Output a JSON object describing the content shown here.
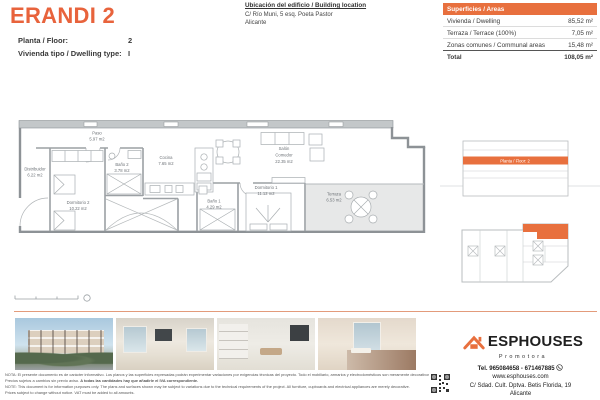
{
  "colors": {
    "accent": "#E8703E",
    "title_orange": "#E8633C",
    "divider": "#E39B7B"
  },
  "header": {
    "title": "ERANDI 2",
    "floor_label": "Planta / Floor:",
    "floor_value": "2",
    "dwelling_label": "Vivienda tipo / Dwelling type:",
    "dwelling_value": "I"
  },
  "location": {
    "heading": "Ubicación del edificio / Building location",
    "line1": "C/ Río Muni, 5 esq. Poeta Pastor",
    "line2": "Alicante"
  },
  "areas_table": {
    "header": "Superficies / Areas",
    "rows": [
      {
        "label": "Vivienda / Dwelling",
        "value": "85,52 m²"
      },
      {
        "label": "Terraza / Terrace (100%)",
        "value": "7,05 m²"
      },
      {
        "label": "Zonas comunes / Communal areas",
        "value": "15,48 m²"
      }
    ],
    "total_label": "Total",
    "total_value": "108,05 m²"
  },
  "plan": {
    "rooms": [
      {
        "name": "Paso",
        "area": "5.97 m2"
      },
      {
        "name": "Distribuidor",
        "area": "6.22 m2"
      },
      {
        "name": "Baño 2",
        "area": "3.78 m2"
      },
      {
        "name": "Cocina",
        "area": "7.65 m2"
      },
      {
        "name": "Salón",
        "name2": "Comedor",
        "area": "22.35 m2"
      },
      {
        "name": "Dormitorio 2",
        "area": "10.22 m2"
      },
      {
        "name": "Dormitorio 1",
        "area": "11.12 m2"
      },
      {
        "name": "Baño 1",
        "area": "4.29 m2"
      },
      {
        "name": "Terraza",
        "area": "6.53 m2"
      }
    ]
  },
  "section_diagram": {
    "label": "Planta / Floor: 2"
  },
  "brand": {
    "name": "ESPHOUSES",
    "tagline": "Promotora",
    "tel": "Tel. 965084658 - 671467885",
    "web": "www.esphouses.com",
    "address": "C/ Sdad. Cult. Dptva. Betis Florida, 19",
    "city": "Alicante"
  },
  "disclaimer": {
    "es1": "NOTA: El presente documento es de carácter informativo. Los planos y las superficies expresadas podrán experimentar variaciones por exigencias técnicas del proyecto. Todo el mobiliario, armarios y electrodomésticos son meramente decorativos.",
    "es2a": "Precios sujetos a cambios sin previo aviso. ",
    "es2b": "A todas las cantidades hay que añadirle el IVA correspondiente.",
    "en1": "NOTE: This document is for information purposes only. The plans and surfaces shown may be subject to variations due to the technical requirements of the project. All furniture, cupboards and electrical appliances are merely decorative.",
    "en2": "Prices subject to change without notice. VAT must be added to all amounts."
  }
}
